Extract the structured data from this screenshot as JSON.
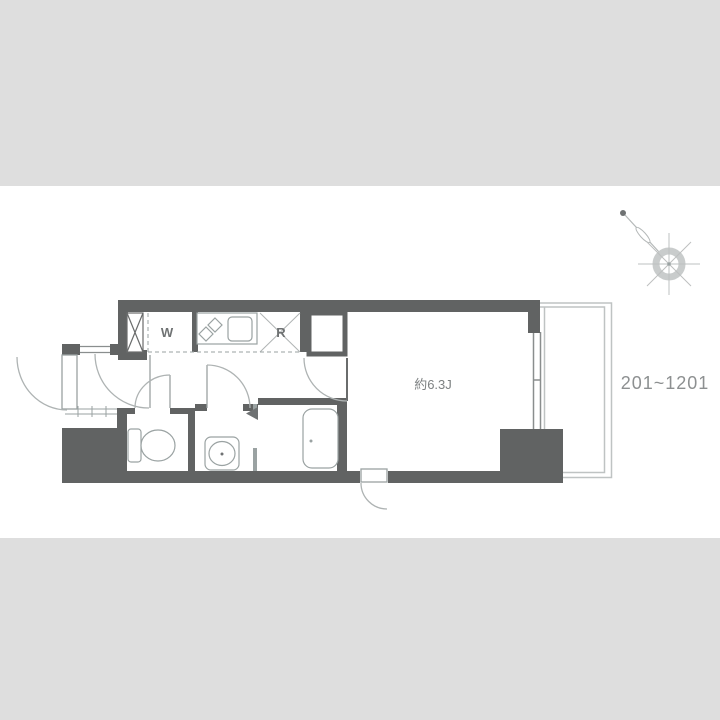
{
  "floor_plan": {
    "labels": {
      "washer_space": "W",
      "refrigerator_space": "R",
      "main_room_size": "約6.3J",
      "unit_numbers": "201~1201"
    },
    "colors": {
      "background_band": "#dedede",
      "wall": "#616363",
      "fixture_line": "#9aa2a2",
      "door_arc": "#aeb3b3",
      "balcony_line": "#bfc3c3",
      "label_text": "#6f7273",
      "unit_text": "#8d9091"
    }
  }
}
